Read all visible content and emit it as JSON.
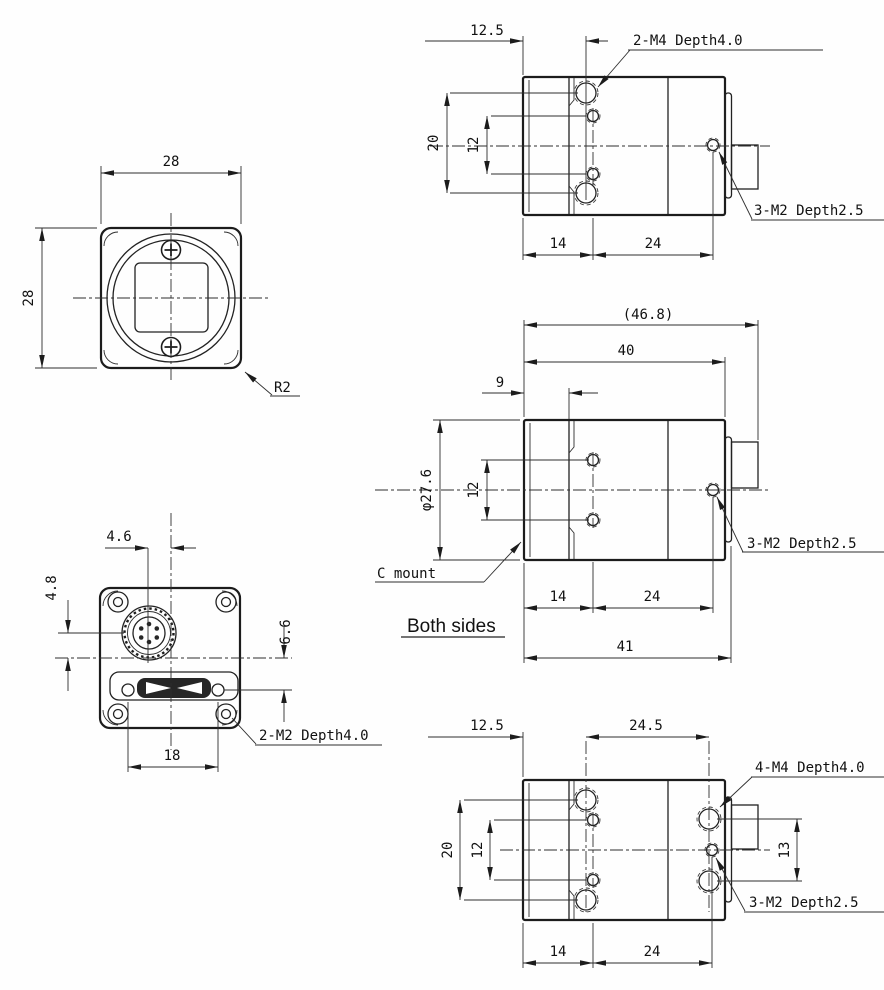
{
  "style": {
    "ink": "#1c1c1c",
    "background": "#ffffff"
  },
  "drawing": {
    "front": {
      "width": "28",
      "height": "28",
      "corner_radius": "R2"
    },
    "top": {
      "offset": "12.5",
      "m4_note": "2-M4 Depth4.0",
      "hole_pitch_outer": "20",
      "hole_pitch_inner": "12",
      "m2_note": "3-M2 Depth2.5",
      "front_to_holes": "14",
      "hole_span": "24"
    },
    "side": {
      "overall_length": "(46.8)",
      "body_length": "40",
      "mount_depth": "9",
      "mount_dia": "φ27.6",
      "hole_pitch": "12",
      "c_mount": "C mount",
      "both_sides": "Both sides",
      "front_to_holes": "14",
      "hole_span": "24",
      "body_with_cover": "41",
      "m2_note": "3-M2 Depth2.5"
    },
    "rear": {
      "conn_offset_x": "4.6",
      "conn_offset_y": "4.8",
      "usb_offset": "6.6",
      "usb_screw_pitch": "18",
      "m2_note": "2-M2 Depth4.0"
    },
    "bottom": {
      "offset": "12.5",
      "rear_hole_offset": "24.5",
      "hole_pitch_outer": "20",
      "hole_pitch_inner": "12",
      "rear_hole_pitch": "13",
      "m4_note": "4-M4 Depth4.0",
      "m2_note": "3-M2 Depth2.5",
      "front_to_holes": "14",
      "hole_span": "24"
    }
  }
}
